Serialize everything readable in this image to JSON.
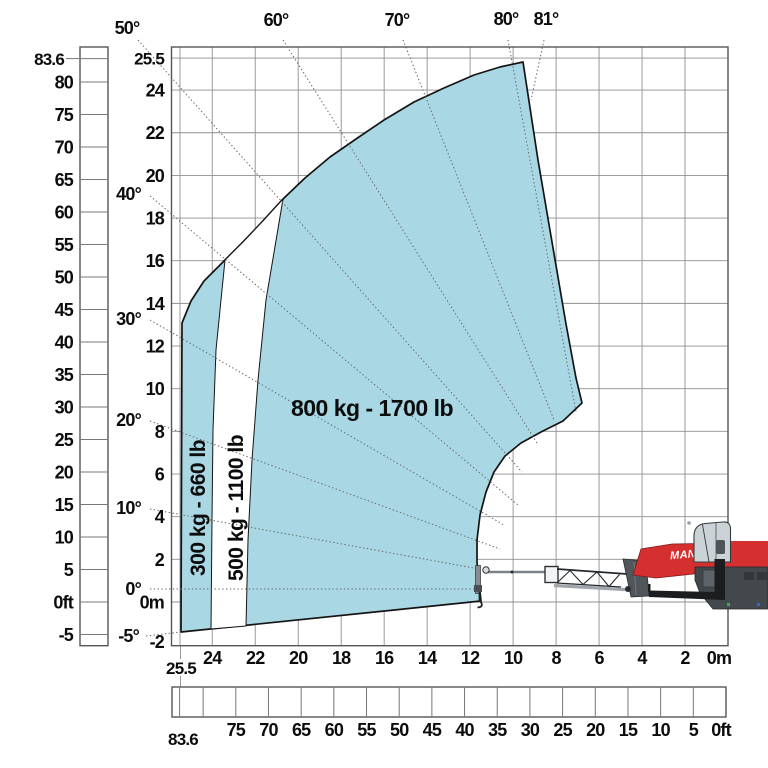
{
  "chart_data": {
    "type": "area",
    "title": "Telescopic handler load capacity envelope with boom angles",
    "units": {
      "metric": "m",
      "imperial": "ft"
    },
    "axes": {
      "height_m": {
        "unit": "m",
        "labels": [
          {
            "t": "25.5",
            "v": 25.5
          },
          {
            "t": "24",
            "v": 24
          },
          {
            "t": "22",
            "v": 22
          },
          {
            "t": "20",
            "v": 20
          },
          {
            "t": "18",
            "v": 18
          },
          {
            "t": "16",
            "v": 16
          },
          {
            "t": "14",
            "v": 14
          },
          {
            "t": "12",
            "v": 12
          },
          {
            "t": "10",
            "v": 10
          },
          {
            "t": "8",
            "v": 8
          },
          {
            "t": "6",
            "v": 6
          },
          {
            "t": "4",
            "v": 4
          },
          {
            "t": "2",
            "v": 2
          },
          {
            "t": "0m",
            "v": 0
          },
          {
            "t": "-2",
            "v": -2
          }
        ]
      },
      "height_ft": {
        "unit": "ft",
        "labels": [
          {
            "t": "83.6",
            "v": 83.6
          },
          {
            "t": "80",
            "v": 80
          },
          {
            "t": "75",
            "v": 75
          },
          {
            "t": "70",
            "v": 70
          },
          {
            "t": "65",
            "v": 65
          },
          {
            "t": "60",
            "v": 60
          },
          {
            "t": "55",
            "v": 55
          },
          {
            "t": "50",
            "v": 50
          },
          {
            "t": "45",
            "v": 45
          },
          {
            "t": "40",
            "v": 40
          },
          {
            "t": "35",
            "v": 35
          },
          {
            "t": "30",
            "v": 30
          },
          {
            "t": "25",
            "v": 25
          },
          {
            "t": "20",
            "v": 20
          },
          {
            "t": "15",
            "v": 15
          },
          {
            "t": "10",
            "v": 10
          },
          {
            "t": "5",
            "v": 5
          },
          {
            "t": "0ft",
            "v": 0
          },
          {
            "t": "-5",
            "v": -5
          }
        ]
      },
      "reach_m": {
        "unit": "m",
        "labels": [
          {
            "t": "25.5",
            "v": 25.5
          },
          {
            "t": "24",
            "v": 24
          },
          {
            "t": "22",
            "v": 22
          },
          {
            "t": "20",
            "v": 20
          },
          {
            "t": "18",
            "v": 18
          },
          {
            "t": "16",
            "v": 16
          },
          {
            "t": "14",
            "v": 14
          },
          {
            "t": "12",
            "v": 12
          },
          {
            "t": "10",
            "v": 10
          },
          {
            "t": "8",
            "v": 8
          },
          {
            "t": "6",
            "v": 6
          },
          {
            "t": "4",
            "v": 4
          },
          {
            "t": "2",
            "v": 2
          },
          {
            "t": "0m",
            "v": 0
          }
        ]
      },
      "reach_ft": {
        "unit": "ft",
        "extra_ticks": [
          80
        ],
        "labels": [
          {
            "t": "83.6",
            "v": 83.6
          },
          {
            "t": "75",
            "v": 75
          },
          {
            "t": "70",
            "v": 70
          },
          {
            "t": "65",
            "v": 65
          },
          {
            "t": "60",
            "v": 60
          },
          {
            "t": "55",
            "v": 55
          },
          {
            "t": "50",
            "v": 50
          },
          {
            "t": "45",
            "v": 45
          },
          {
            "t": "40",
            "v": 40
          },
          {
            "t": "35",
            "v": 35
          },
          {
            "t": "30",
            "v": 30
          },
          {
            "t": "25",
            "v": 25
          },
          {
            "t": "20",
            "v": 20
          },
          {
            "t": "15",
            "v": 15
          },
          {
            "t": "10",
            "v": 10
          },
          {
            "t": "5",
            "v": 5
          },
          {
            "t": "0ft",
            "v": 0
          }
        ]
      }
    },
    "boom_angles": {
      "left": [
        {
          "t": "-5°",
          "deg": -5
        },
        {
          "t": "0°",
          "deg": 0
        },
        {
          "t": "10°",
          "deg": 10
        },
        {
          "t": "20°",
          "deg": 20
        },
        {
          "t": "30°",
          "deg": 30
        },
        {
          "t": "40°",
          "deg": 40
        }
      ],
      "top": [
        {
          "t": "50°",
          "deg": 50
        },
        {
          "t": "60°",
          "deg": 60
        },
        {
          "t": "70°",
          "deg": 70
        },
        {
          "t": "80°",
          "deg": 80
        },
        {
          "t": "81°",
          "deg": 81
        }
      ]
    },
    "capacity_zones": [
      {
        "label": "300 kg - 660 lb",
        "kg": 300,
        "lb": 660,
        "orientation": "vertical"
      },
      {
        "label": "500 kg - 1100 lb",
        "kg": 500,
        "lb": 1100,
        "orientation": "vertical"
      },
      {
        "label": "800 kg - 1700 lb",
        "kg": 800,
        "lb": 1700,
        "orientation": "horizontal"
      }
    ],
    "envelope": {
      "max_height_m": 25.5,
      "max_height_ft": 83.6,
      "max_reach_m": 25.5,
      "max_reach_ft": 83.6,
      "min_boom_angle_deg": -5,
      "max_boom_angle_deg": 81
    }
  },
  "machine": {
    "brand_text": "MANI",
    "description": "telehandler side view"
  },
  "colors": {
    "zone_fill": "#a9d8e4",
    "outline": "#141414",
    "grid": "#8f8f8f",
    "machine_red": "#d62f30",
    "machine_red_dark": "#7e1a1c",
    "cab_gray": "#ccd3d7",
    "dark": "#1b1d1f",
    "under_gray": "#43484d"
  }
}
